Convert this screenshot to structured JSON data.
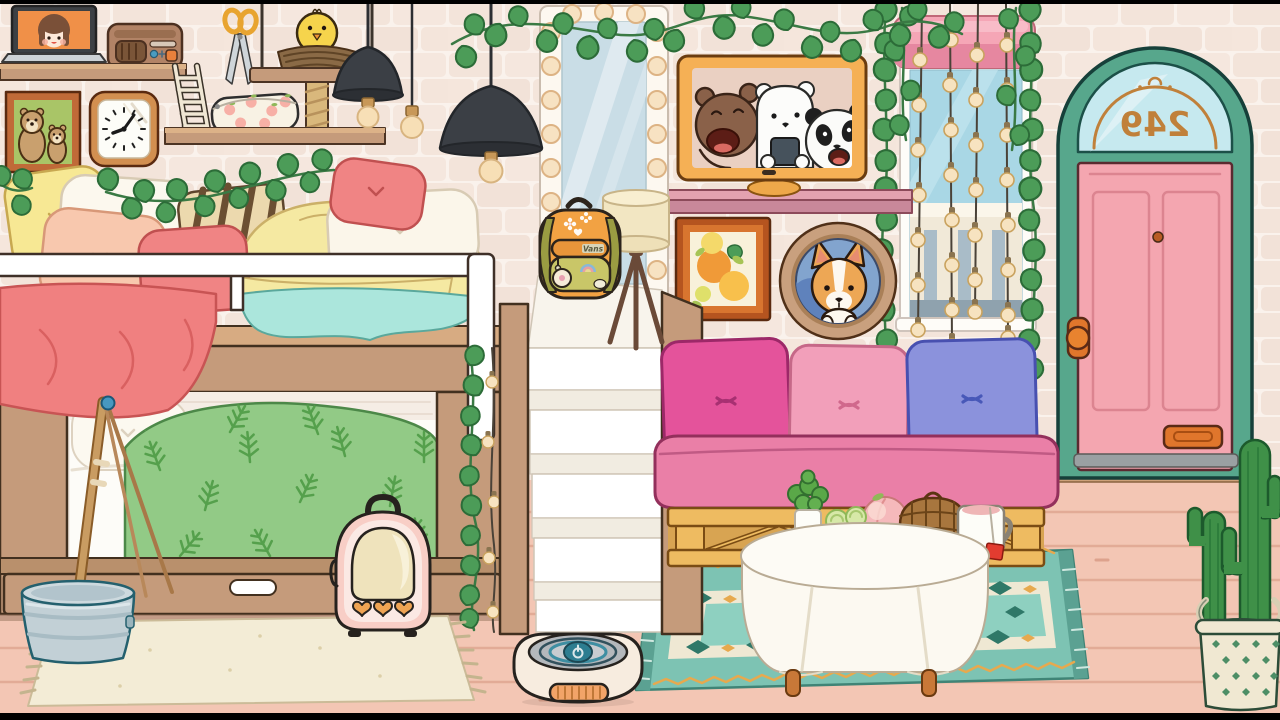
{
  "meta": {
    "scene": "cozy-pink-bedroom",
    "style": "toca-life-cartoon",
    "width": 1280,
    "height": 720
  },
  "door": {
    "number_plate": "249",
    "mirrored": true
  },
  "backpack": {
    "brand_label": "Vans"
  },
  "palette": {
    "wall_mortar": "#faf2ec",
    "wall_brick": "#f3e4da",
    "floor": "#f3c6b4",
    "floor_line": "#e2ab96",
    "wood": "#c59b7b",
    "wood_dark": "#42301f",
    "door_teal": "#57a78c",
    "door_pink": "#f4a6b0",
    "door_hardware": "#e0762c",
    "door_number_color": "#c0803a",
    "ivy_green": "#4c9c58",
    "string_light_bulb": "#f7e3c0",
    "couch_seat": "#ea7fa7",
    "pillow_magenta": "#e4539b",
    "pillow_pink": "#f29fba",
    "pillow_periwinkle": "#8b92dc",
    "pallet_wood": "#eebb61",
    "rug_teal": "#7dc3b3",
    "rug_cream": "#f3ecd6",
    "blanket_green": "#92ca86",
    "blanket_teal": "#abe6dc",
    "blanket_red": "#f08080",
    "backpack_orange": "#f2a243",
    "tv_frame": "#f5b055",
    "pendant_lamp": "#3b3f45",
    "vacuum_ring": "#3e8ea2",
    "carrier_pink": "#f8cec6",
    "cactus_green": "#3f9048"
  },
  "objects": [
    "laptop",
    "radio",
    "scissors",
    "bird-nest-swing",
    "pencil-case",
    "ladder",
    "cat-post",
    "family-portrait",
    "wall-clock",
    "pendant-lamps",
    "vanity-mirror",
    "tv-bears",
    "wall-shelf",
    "citrus-painting",
    "dog-porthole",
    "window-string-lights",
    "arched-door",
    "bunk-bed",
    "stairs",
    "backpack",
    "tripod-lamp",
    "pallet-couch",
    "round-table",
    "snack-tray",
    "tea-mug",
    "teal-rug",
    "cream-rug",
    "robot-vacuum",
    "pet-carrier",
    "mop-bucket",
    "cactus",
    "ivy-garlands"
  ]
}
